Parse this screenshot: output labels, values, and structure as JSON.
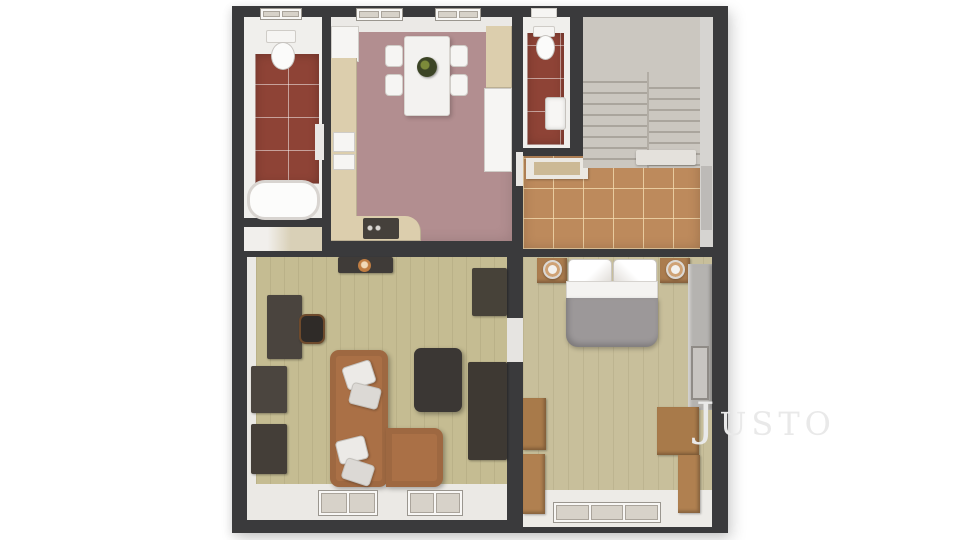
{
  "watermark": {
    "text": "Justo"
  },
  "floorplan": {
    "view": "3d-top-down-floor-plan",
    "rooms": [
      {
        "name": "bathroom",
        "position": "top-left",
        "floor": "red-tile",
        "fixtures": [
          "toilet",
          "bathtub",
          "window",
          "door"
        ]
      },
      {
        "name": "kitchen-dining",
        "position": "top-center",
        "floor": "mauve-carpet",
        "fixtures": [
          "dining-table",
          "chair x4",
          "plant-centerpiece",
          "corner-cabinet",
          "counter",
          "sink",
          "stove",
          "fridge",
          "window x2"
        ]
      },
      {
        "name": "wc",
        "position": "top-middle-right",
        "floor": "red-tile",
        "fixtures": [
          "toilet",
          "wash-basin",
          "vent-window"
        ]
      },
      {
        "name": "hallway-stairs",
        "position": "top-right",
        "floor": "terracotta-tile",
        "fixtures": [
          "staircase-two-flights",
          "doormat",
          "entry-door"
        ]
      },
      {
        "name": "living-room",
        "position": "bottom-left",
        "floor": "light-wood",
        "fixtures": [
          "corner-sofa",
          "cushion x4",
          "coffee-table",
          "tv-stand",
          "candle",
          "desk",
          "desk-chair",
          "cabinet x2",
          "media-unit x2",
          "window x2"
        ]
      },
      {
        "name": "bedroom",
        "position": "bottom-right",
        "floor": "light-wood",
        "fixtures": [
          "double-bed",
          "pillow x2",
          "nightstand x2",
          "lamp x2",
          "wardrobe",
          "dresser x2",
          "window"
        ]
      }
    ],
    "colors": {
      "background": "#ffffff",
      "wall": "#3a3a3c",
      "bath_tile": "#8e4336",
      "hall_tile": "#bd8a5c",
      "kitchen_floor": "#b28e90",
      "stairs_carpet": "#cbc7c0",
      "stairs_tread": "#aaa59d",
      "living_floor": "#c5bc92",
      "bedroom_floor": "#c8bf9b",
      "sofa": "#aa7046",
      "dark_furniture": "#46413c",
      "wood_furniture": "#ab7c4e",
      "duvet": "#9c9899",
      "wardrobe_gray": "#b5b3b0",
      "watermark": "#e9e9e9"
    }
  }
}
